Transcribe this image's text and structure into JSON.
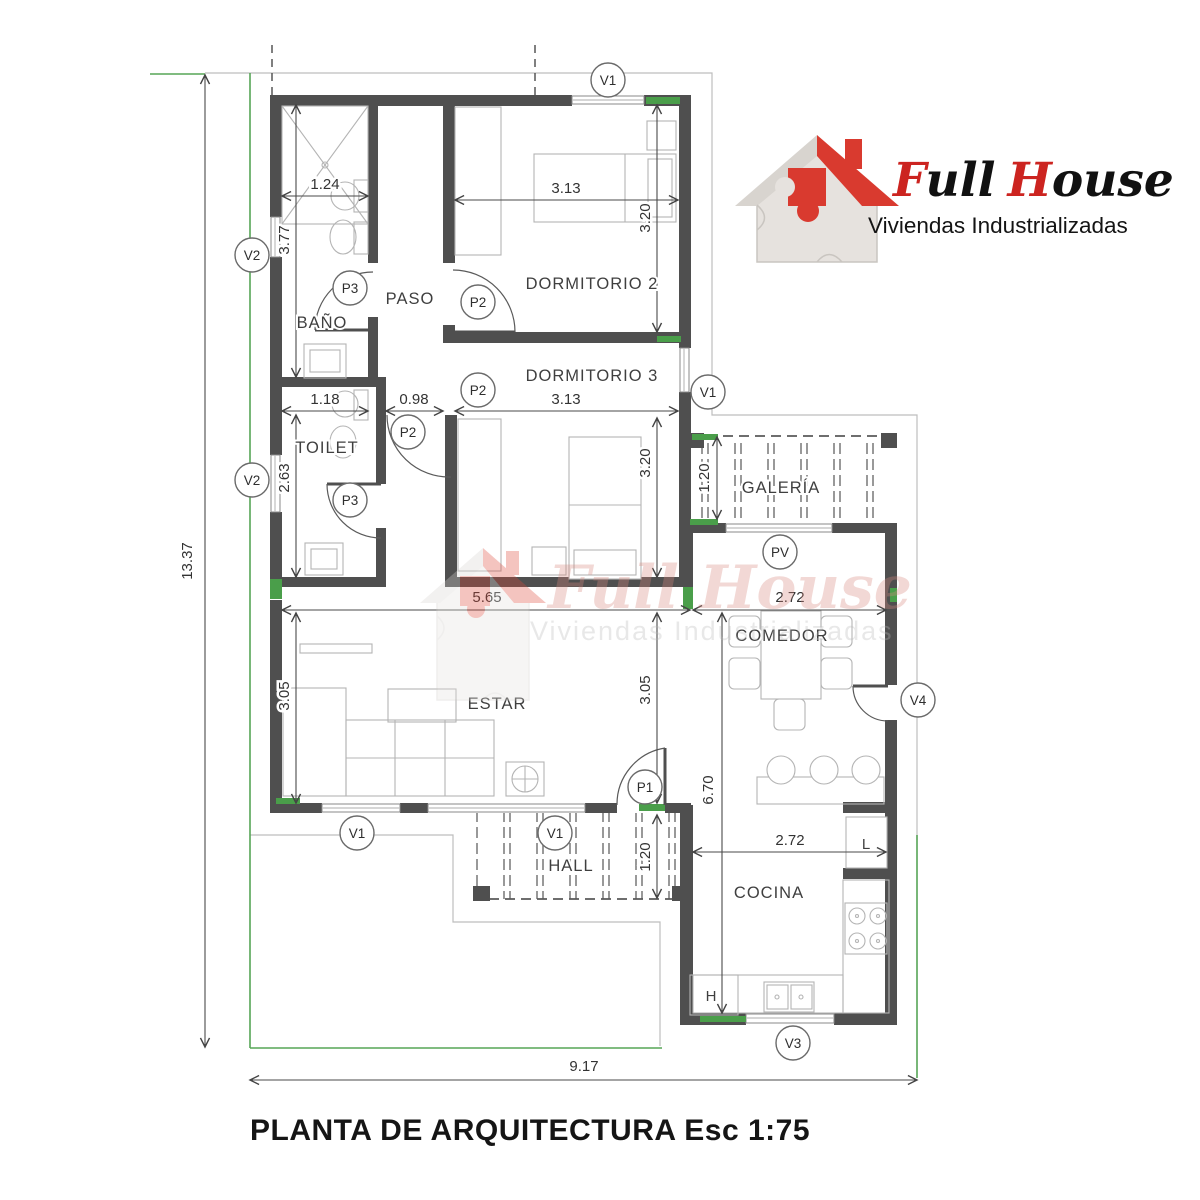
{
  "header": {
    "logo": {
      "f": "F",
      "ull": "ull",
      "h": "H",
      "ouse": "ouse",
      "tagline": "Viviendas Industrializadas"
    }
  },
  "watermark": {
    "brand": "Full House",
    "tagline": "Viviendas Industrializadas"
  },
  "plan": {
    "title": "PLANTA DE ARQUITECTURA Esc 1:75",
    "rooms": {
      "bano": "BAÑO",
      "paso": "PASO",
      "dorm2": "DORMITORIO 2",
      "dorm3": "DORMITORIO 3",
      "toilet": "TOILET",
      "estar": "ESTAR",
      "galeria": "GALERÍA",
      "comedor": "COMEDOR",
      "cocina": "COCINA",
      "hall": "HALL",
      "laundry": "L",
      "heater": "H"
    },
    "markers": {
      "v1": "V1",
      "v2": "V2",
      "v3": "V3",
      "v4": "V4",
      "pv": "PV",
      "p1": "P1",
      "p2": "P2",
      "p3": "P3"
    },
    "dims": {
      "w_bano": "1.24",
      "h_bano": "3.77",
      "w_dorm2": "3.13",
      "h_dorm2": "3.20",
      "w_toilet": "1.18",
      "w_pass": "0.98",
      "w_dorm3": "3.13",
      "h_dorm3": "3.20",
      "h_toilet": "2.63",
      "w_estar": "5.65",
      "w_comedor": "2.72",
      "h_estar_l": "3.05",
      "h_estar_r": "3.05",
      "h_galeria": "1.20",
      "h_block_right": "6.70",
      "w_cocina": "2.72",
      "h_hall": "1.20",
      "total_h": "13.37",
      "total_w": "9.17"
    }
  },
  "colors": {
    "wall": "#4f4f4f",
    "accent_green": "#4a9e4a",
    "brand_red": "#d5382b",
    "line_gray": "#9a9a9a"
  }
}
